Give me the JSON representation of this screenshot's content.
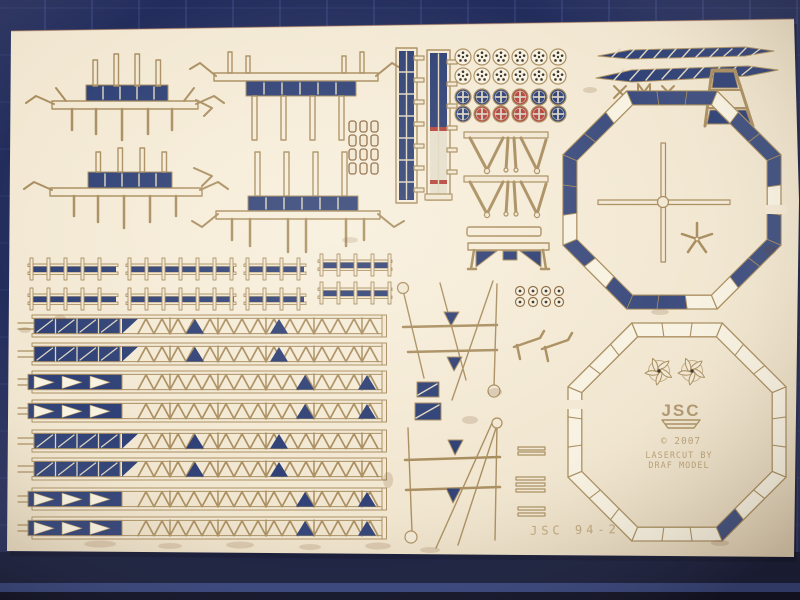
{
  "markings": {
    "logo": "JSC",
    "copyright": "© 2007",
    "lasercut_line1": "LASERCUT BY",
    "lasercut_line2": "DRAF MODEL",
    "sheet_number": "JSC 94-2"
  },
  "palette": {
    "mat": "#232d5c",
    "mat_grid": "#4a5a99",
    "mat_edge_light": "#32427e",
    "mat_dark": "#10163a",
    "sheet": "#f2e8d4",
    "outline": "#a98e60",
    "burn": "#8a6840",
    "blue": "#2e4076",
    "red": "#b5443c",
    "white": "#f8f2e2",
    "dot": "#3a332c",
    "text": "#a5895c"
  },
  "wheel_grid": {
    "x0": 463,
    "dx": 19,
    "rows_y": [
      57,
      76,
      97,
      114
    ],
    "radius": 8,
    "row_types": [
      "disc",
      "disc",
      "spoked",
      "spoked"
    ],
    "spoked_colors": [
      [
        "blue",
        "blue",
        "blue",
        "red",
        "blue",
        "blue"
      ],
      [
        "blue",
        "red",
        "red",
        "red",
        "red",
        "blue"
      ]
    ]
  },
  "girders": {
    "x0": 18,
    "x1": 386,
    "height": 22,
    "rows_y": [
      315,
      343,
      371,
      400,
      430,
      458,
      488,
      517
    ],
    "patterns": [
      "panels",
      "panels",
      "arrows",
      "arrows",
      "panels",
      "panels",
      "arrows",
      "arrows"
    ],
    "truss_triangles": {
      "panels": [
        186,
        270
      ],
      "arrows": [
        296,
        358
      ]
    }
  },
  "railings": [
    {
      "x0": 28,
      "x1": 118,
      "y": 258
    },
    {
      "x0": 126,
      "x1": 236,
      "y": 258
    },
    {
      "x0": 244,
      "x1": 306,
      "y": 258
    },
    {
      "x0": 28,
      "x1": 118,
      "y": 288
    },
    {
      "x0": 126,
      "x1": 236,
      "y": 288
    },
    {
      "x0": 244,
      "x1": 306,
      "y": 288
    },
    {
      "x0": 318,
      "x1": 392,
      "y": 254
    },
    {
      "x0": 318,
      "x1": 392,
      "y": 282
    }
  ],
  "eyelet_rects": {
    "x0": 349,
    "dx": 11,
    "cols": 3,
    "y0": 121,
    "dy": 14,
    "rows": 4,
    "w": 7,
    "h": 11
  },
  "eyelet_circles": {
    "x0": 520,
    "dx": 13,
    "cols": 4,
    "y0": 291,
    "dy": 11,
    "rows": 2,
    "r": 4.5
  },
  "octagons": {
    "top": {
      "cx": 672,
      "cy": 200,
      "r_out": 118,
      "r_in": 103,
      "blue_cells": [
        [
          0,
          0
        ],
        [
          0,
          1
        ],
        [
          0,
          2
        ],
        [
          1,
          1
        ],
        [
          1,
          2
        ],
        [
          2,
          0
        ],
        [
          2,
          2
        ],
        [
          3,
          0
        ],
        [
          3,
          1
        ],
        [
          4,
          1
        ],
        [
          4,
          2
        ],
        [
          5,
          0
        ],
        [
          5,
          2
        ],
        [
          6,
          1
        ],
        [
          6,
          2
        ],
        [
          7,
          0
        ],
        [
          7,
          1
        ]
      ]
    },
    "bottom": {
      "cx": 677,
      "cy": 432,
      "r_out": 118,
      "r_in": 103,
      "blue_cells": [
        [
          3,
          2
        ]
      ]
    }
  }
}
